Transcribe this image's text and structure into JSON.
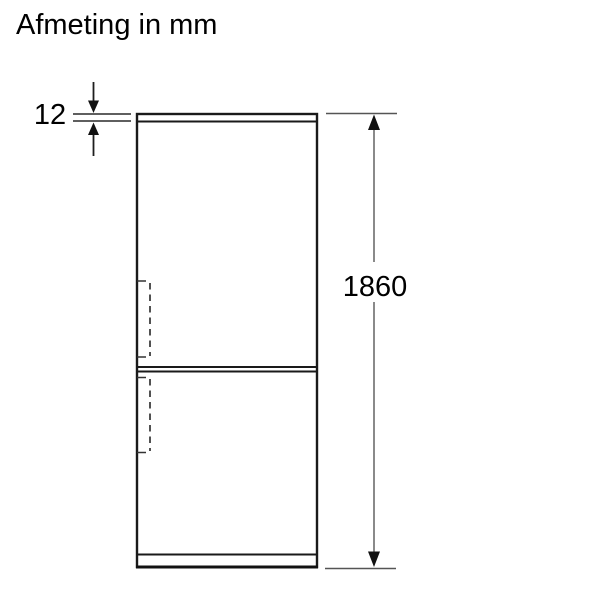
{
  "title": "Afmeting in mm",
  "diagram": {
    "type": "product-dimension-drawing",
    "subject": "fridge-freezer front view",
    "unit": "mm",
    "dimensions": {
      "top_panel_thickness": {
        "label": "12",
        "meaning": "top panel height"
      },
      "overall_height": {
        "label": "1860",
        "meaning": "overall appliance height"
      }
    },
    "colors": {
      "background": "#ffffff",
      "outline": "#1a1a1a",
      "dimension_line": "#8a8a8a",
      "extension_line": "#555555",
      "arrow": "#111111",
      "text": "#000000"
    }
  }
}
